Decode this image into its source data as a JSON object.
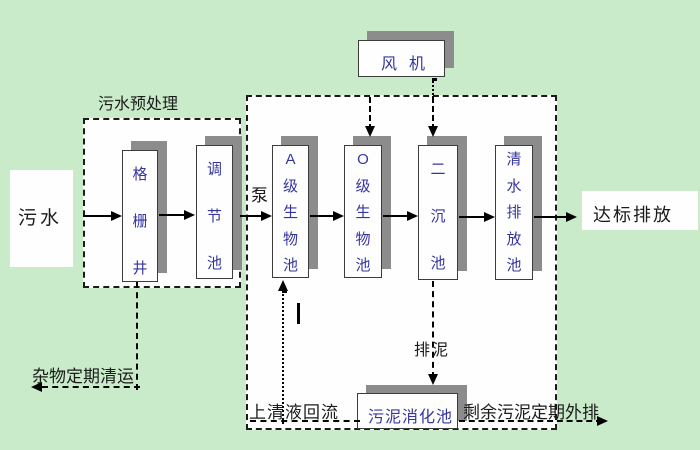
{
  "diagram": {
    "title_context": "wastewater-treatment-process-flow",
    "labels": {
      "influent": "污水",
      "pretreatment": "污水预处理",
      "pump": "泵",
      "blower": "风机",
      "discharge": "达标排放",
      "debris_removal": "杂物定期清运",
      "supernatant_return": "上清液回流",
      "sludge_discharge": "排泥",
      "excess_sludge": "剩余污泥定期外排"
    },
    "tanks": [
      {
        "name": "grid-well",
        "label": "格栅井"
      },
      {
        "name": "regulating-tank",
        "label": "调节池"
      },
      {
        "name": "tank-a",
        "label": "A级生物池"
      },
      {
        "name": "tank-o",
        "label": "O级生物池"
      },
      {
        "name": "secondary-clarifier",
        "label": "二沉池"
      },
      {
        "name": "clearwater-discharge-tank",
        "label": "清水排放池"
      },
      {
        "name": "sludge-digestion-tank",
        "label": "污泥消化池"
      }
    ],
    "colors": {
      "background": "#c9ebc9",
      "box_fill": "#fefefe",
      "box_shadow": "#8c8c8c",
      "tank_text": "#3535a0",
      "outline_text": "#1b1b1b",
      "line": "#000000"
    }
  }
}
